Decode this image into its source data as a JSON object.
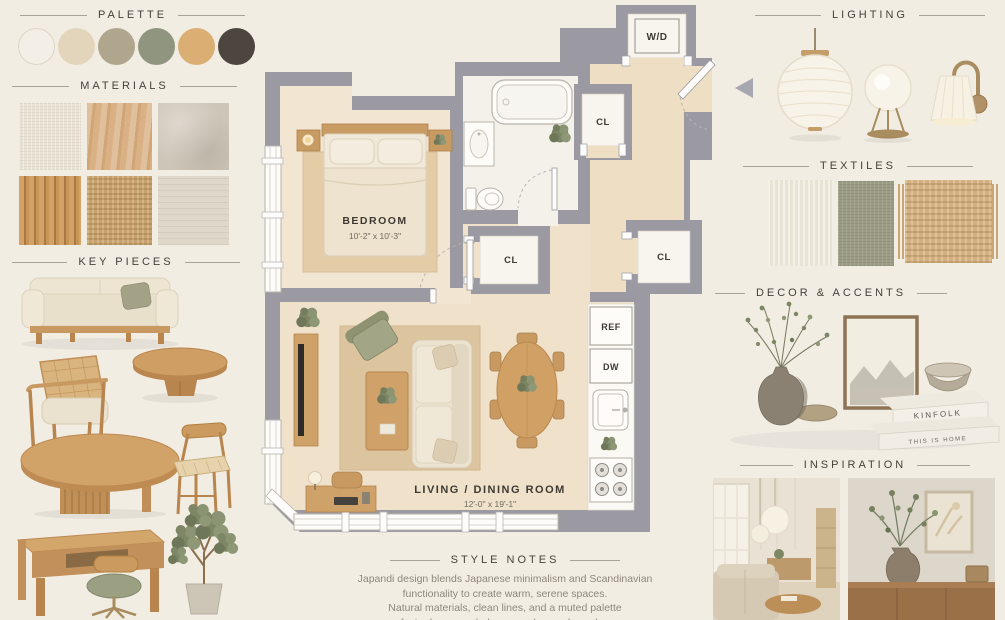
{
  "board": {
    "background": "#F2EDE3",
    "wall_gray": "#9B9AA2",
    "wood_floor": "#EFE1CA",
    "heading_color": "#44413B",
    "divider_line_color": "#A9A295",
    "accent_wood": "#CFA169",
    "accent_sage": "#9BA083"
  },
  "sections": {
    "palette": {
      "title": "PALETTE"
    },
    "materials": {
      "title": "MATERIALS"
    },
    "key_pieces": {
      "title": "KEY PIECES"
    },
    "lighting": {
      "title": "LIGHTING"
    },
    "textiles": {
      "title": "TEXTILES"
    },
    "decor": {
      "title": "DECOR & ACCENTS"
    },
    "inspiration": {
      "title": "INSPIRATION"
    },
    "style_notes": {
      "title": "STYLE NOTES"
    }
  },
  "palette_swatches": [
    "#F4EFE6",
    "#E3D5BB",
    "#B0A68E",
    "#8F957E",
    "#DBAE74",
    "#4D463F"
  ],
  "materials_swatches": [
    "linen-weave",
    "white-oak-wood",
    "beige-limestone",
    "fluted-wood-slats",
    "woven-jute",
    "travertine-stone"
  ],
  "key_pieces_items": [
    "linen-sofa",
    "round-coffee-table",
    "cane-armchair",
    "oval-dining-table",
    "spindle-dining-chair",
    "wood-desk",
    "desk-chair",
    "olive-tree"
  ],
  "floor_plan": {
    "bedroom_label": "BEDROOM",
    "bedroom_dims": "10'-2\" x 10'-3\"",
    "living_label": "LIVING / DINING ROOM",
    "living_dims": "12'-0\" x 19'-1\"",
    "washer_dryer_label": "W/D",
    "closet_hall_label": "CL",
    "closet_mid_label": "CL",
    "closet_entry_label": "CL",
    "fridge_label": "REF",
    "dishwasher_label": "DW"
  },
  "lighting_items": [
    "paper-lantern-pendant",
    "globe-tripod-table-lamp",
    "brass-wall-sconce"
  ],
  "textiles_swatches": [
    "cream-linen",
    "sage-green-weave",
    "fringed-jute"
  ],
  "decor_items": [
    "ceramic-vase-with-branches",
    "wood-plate",
    "ink-landscape-art",
    "ceramic-bowl",
    "book-stack"
  ],
  "decor_books": {
    "book1": "KINFOLK",
    "book2": "THIS IS HOME"
  },
  "inspiration_photos": [
    "living-room-with-paper-pendants",
    "sideboard-with-vase-and-art"
  ],
  "style_notes": {
    "line1": "Japandi design blends Japanese minimalism and Scandinavian",
    "line2": "functionality to create warm, serene spaces.",
    "line3": "Natural materials, clean lines, and a muted palette",
    "line4": "foster harmony, balance, and everyday calm."
  }
}
